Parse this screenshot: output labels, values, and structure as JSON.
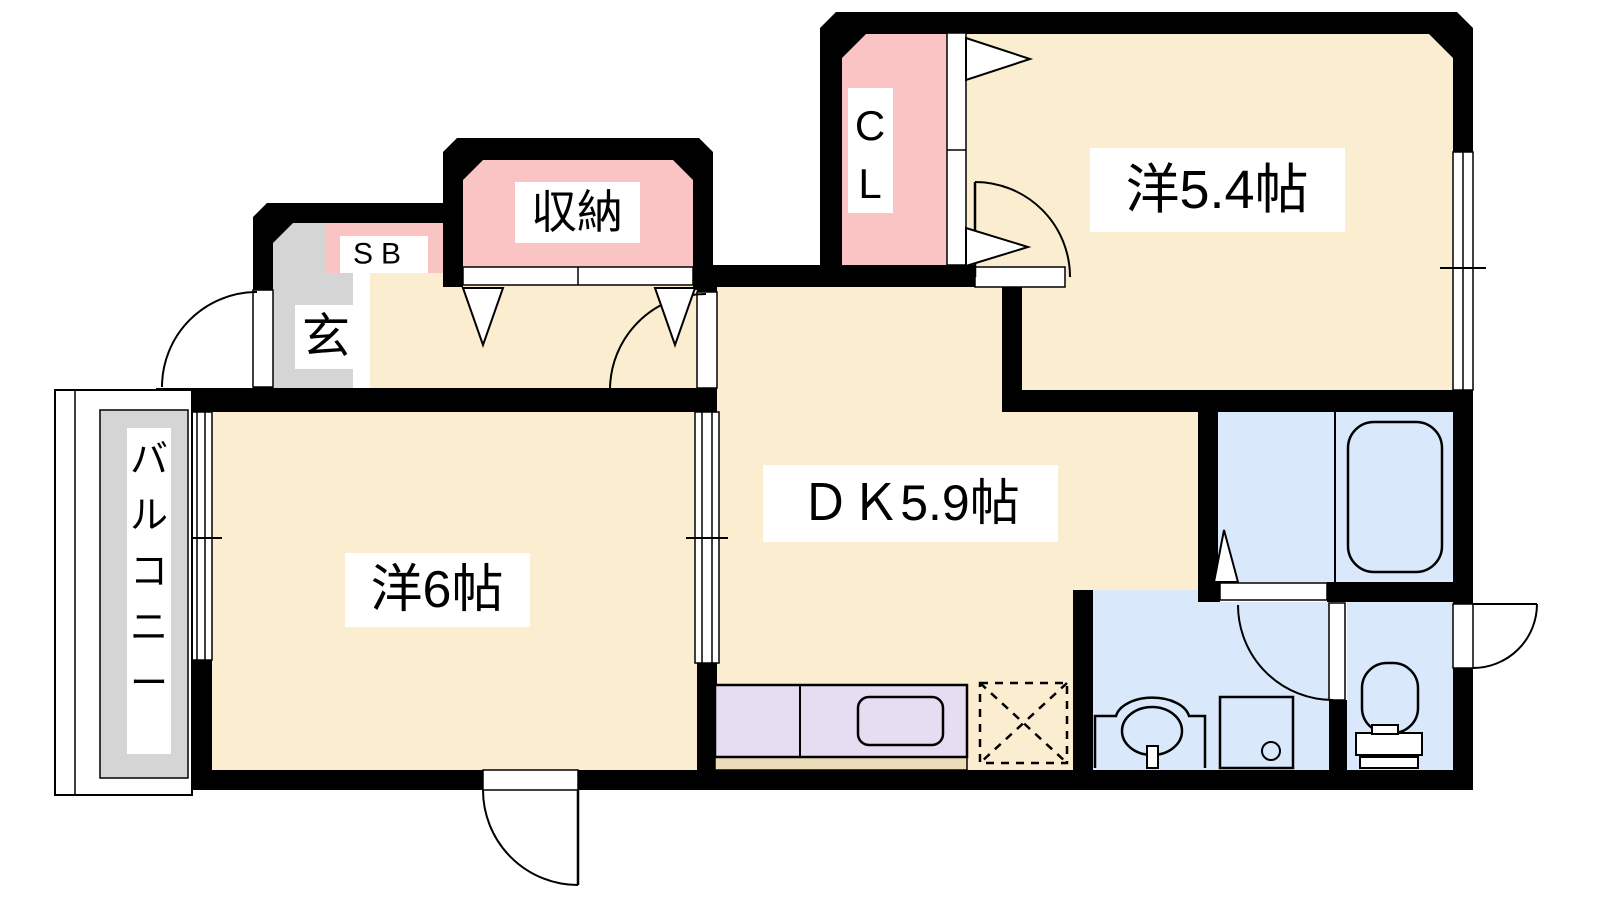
{
  "plan_type": "apartment-floor-plan",
  "rooms": {
    "east_room": {
      "label": "洋5.4帖"
    },
    "west_room": {
      "label": "洋6帖"
    },
    "dining_kitchen": {
      "label": "ＤＫ5.9帖"
    },
    "storage": {
      "label": "収納"
    },
    "closet": {
      "label": "CL"
    },
    "shoe_box": {
      "label": "SB"
    },
    "entrance": {
      "label": "玄"
    },
    "balcony": {
      "label": "バルコニー"
    }
  },
  "colors": {
    "floor_cream": "#FBEED0",
    "closet_pink": "#FBC4C4",
    "entrance_gray": "#D5D5D5",
    "bath_blue": "#D9E9FB",
    "kitchen_lavender": "#E7DDF3",
    "kitchen_kick_tan": "#EBDCBA",
    "wall_black": "#000000",
    "background_white": "#FFFFFF"
  }
}
